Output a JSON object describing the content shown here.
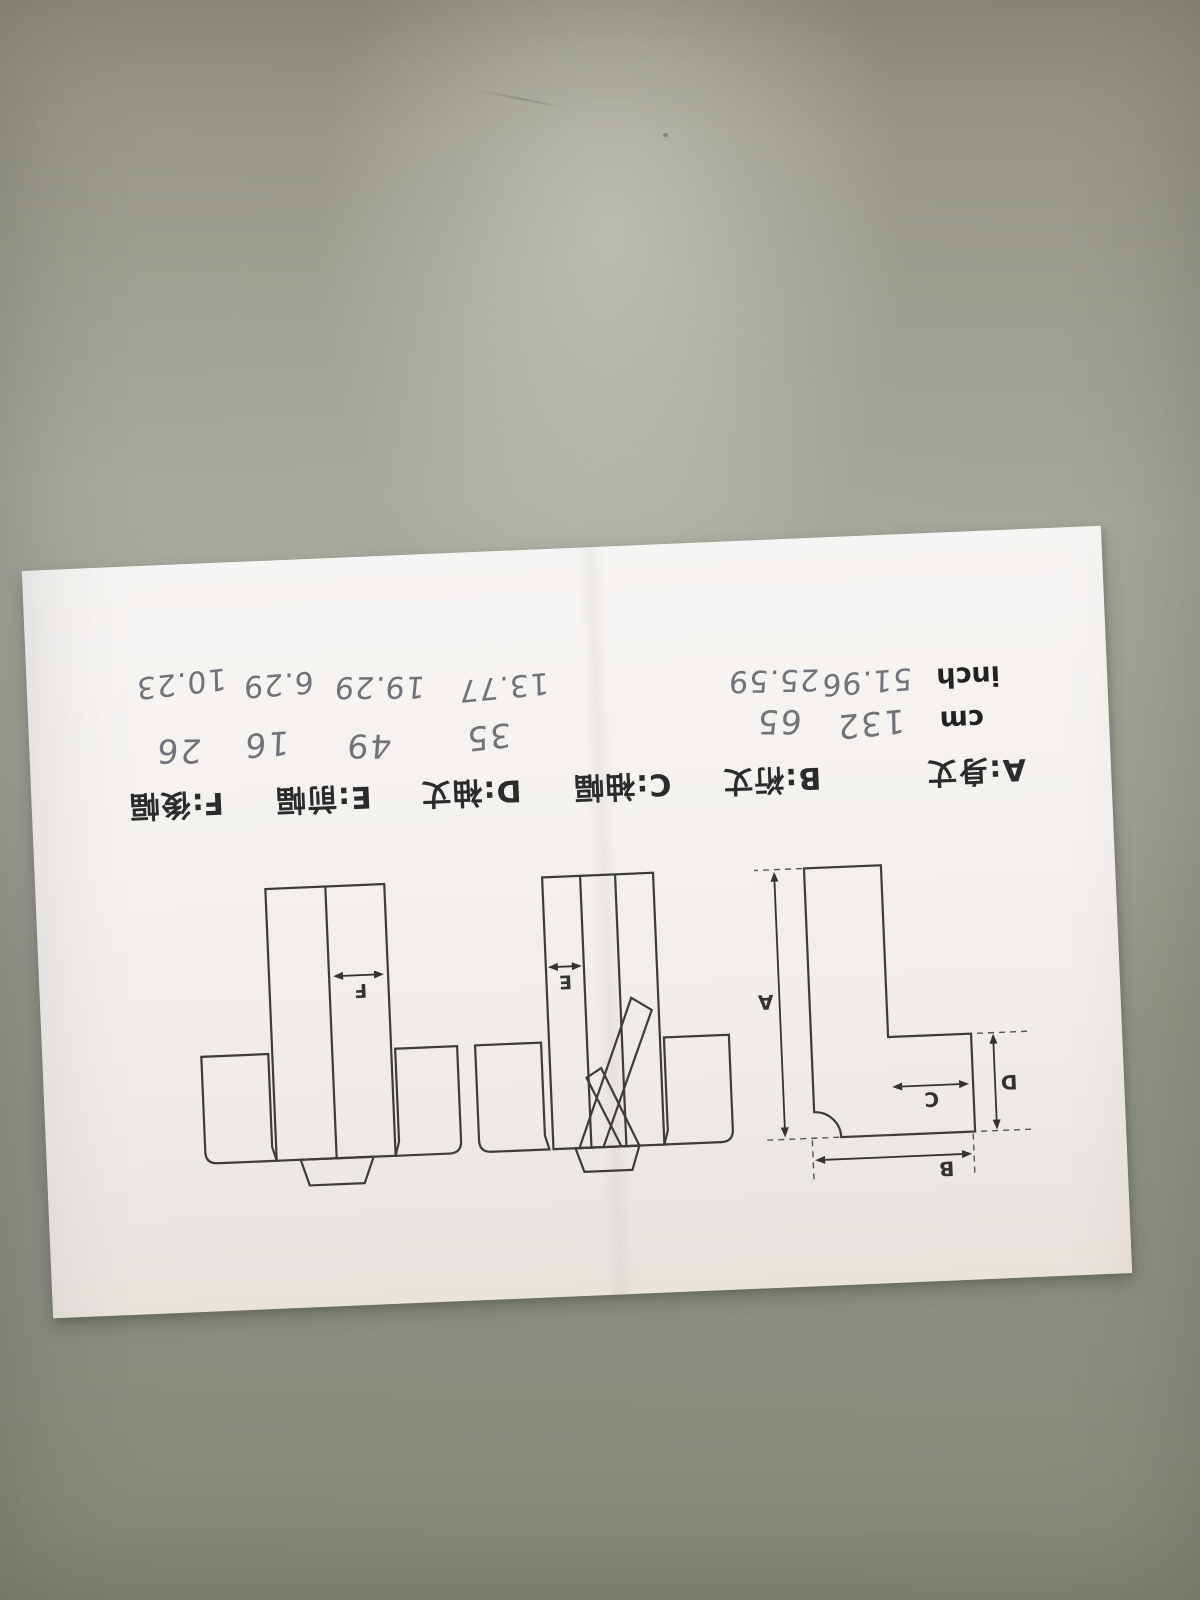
{
  "sheet": {
    "legend": [
      "A:身丈",
      "B:裄丈",
      "C:袖幅",
      "D:袖丈",
      "E:前幅",
      "F:後幅"
    ],
    "units": {
      "cm": {
        "label": "cm",
        "values": [
          "132",
          "65",
          "35",
          "49",
          "16",
          "26"
        ]
      },
      "inch": {
        "label": "inch",
        "values": [
          "51.96",
          "25.59",
          "13.77",
          "19.29",
          "6.29",
          "10.23"
        ]
      }
    },
    "letters": {
      "A": "A",
      "B": "B",
      "C": "C",
      "D": "D",
      "E": "E",
      "F": "F"
    },
    "colors": {
      "desk": "#9a9d92",
      "paper": "#f4f1ed",
      "ink": "#2d2d2d",
      "pencil": "#70747a",
      "line": "#3c3c3c"
    }
  }
}
